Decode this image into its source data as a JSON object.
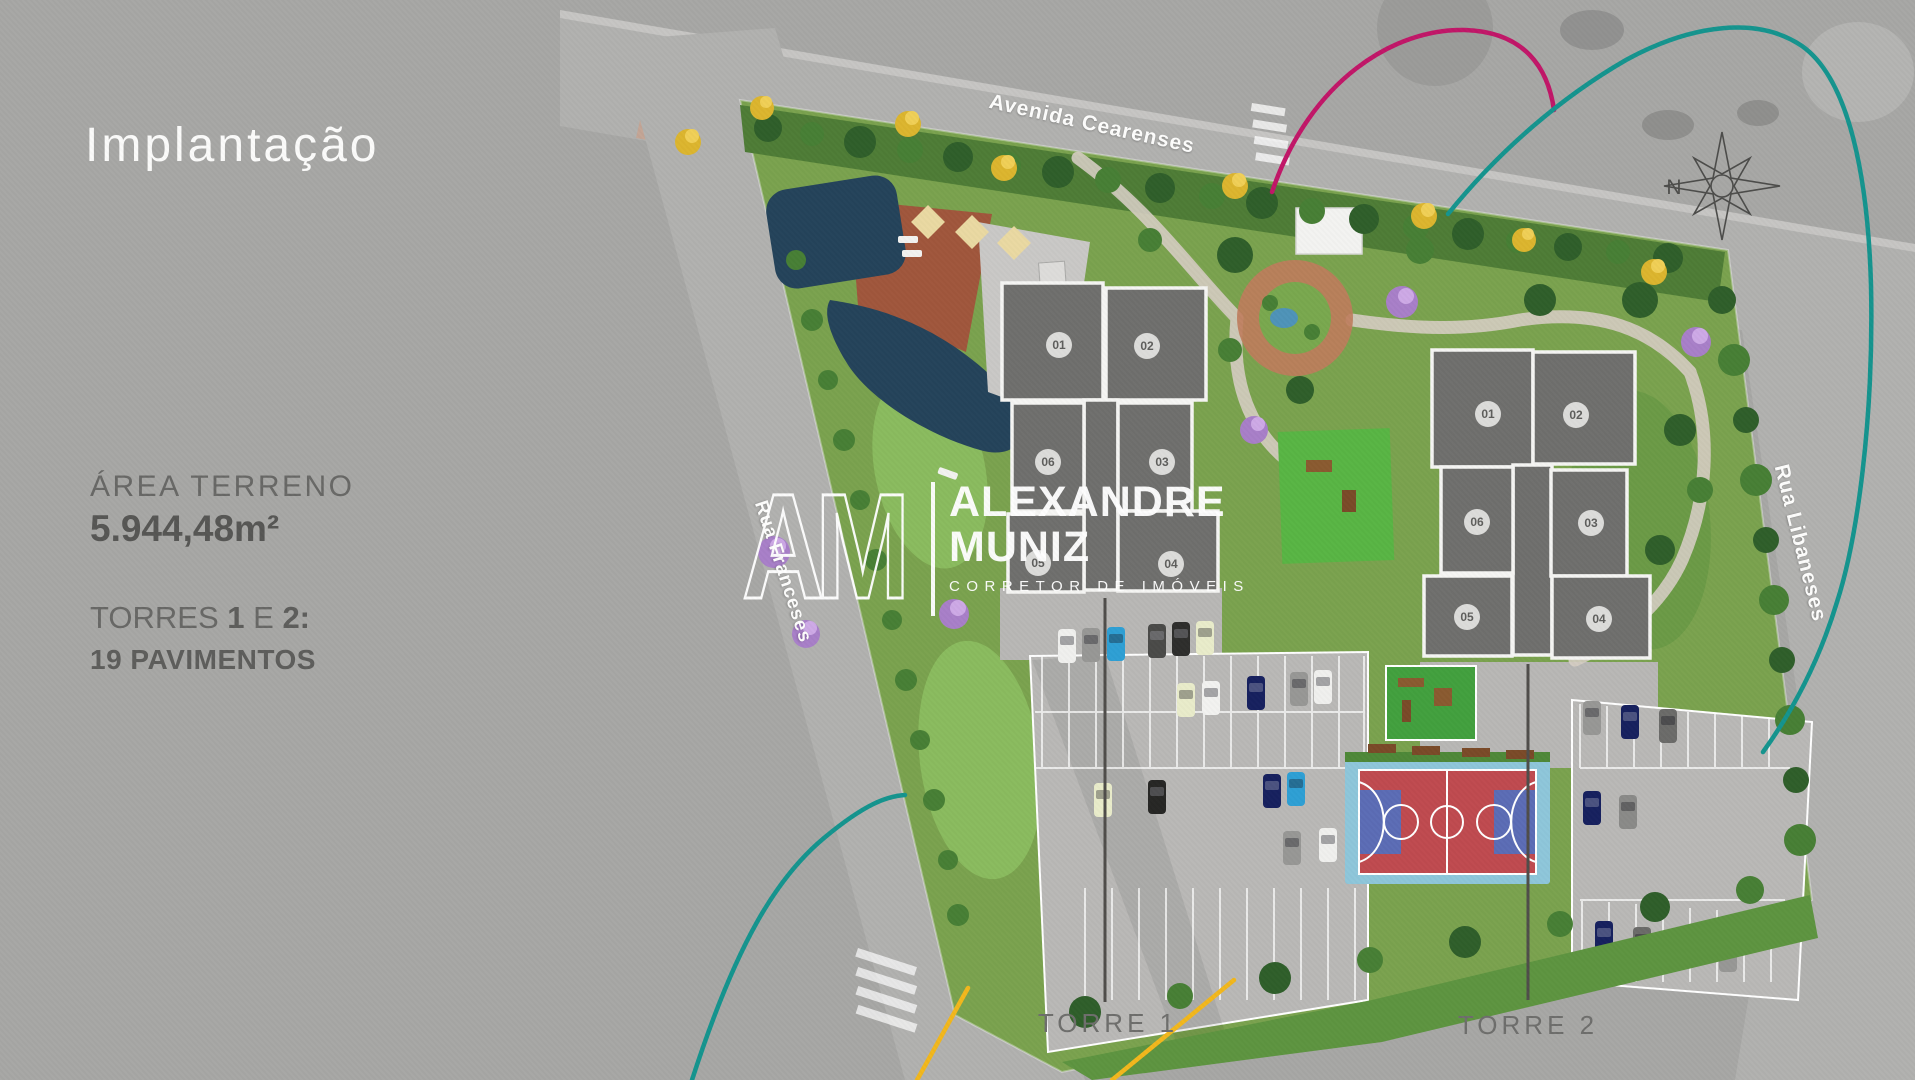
{
  "panel": {
    "title": "Implantação",
    "area_label": "ÁREA TERRENO",
    "area_value": "5.944,48m²",
    "towers_word": "TORRES",
    "tower_num_1": "1",
    "towers_conj": "E",
    "tower_num_2": "2:",
    "pavimentos": "19 PAVIMENTOS"
  },
  "map": {
    "streets": {
      "top": "Avenida Cearenses",
      "left": "Rua Franceses",
      "right": "Rua Libaneses"
    },
    "compass": "N",
    "towers": [
      {
        "label": "TORRE 1",
        "units": [
          "01",
          "02",
          "06",
          "03",
          "05",
          "04"
        ]
      },
      {
        "label": "TORRE 2",
        "units": [
          "01",
          "02",
          "06",
          "03",
          "05",
          "04"
        ]
      }
    ],
    "amenities": [
      "pool",
      "deck",
      "playground",
      "sports-court",
      "parking",
      "gardens"
    ]
  },
  "watermark": {
    "initials": "AM",
    "line1": "ALEXANDRE",
    "line2": "MUNIZ",
    "tagline": "CORRETOR DE IMÓVEIS"
  },
  "colors": {
    "background": "#a7a7a5",
    "accent_magenta": "#c11668",
    "accent_teal": "#14948e",
    "accent_yellow": "#f2b71c",
    "tower_slab": "#6f6f6d",
    "court_red": "#bf4a4f",
    "court_blue": "#5b6cb5"
  }
}
